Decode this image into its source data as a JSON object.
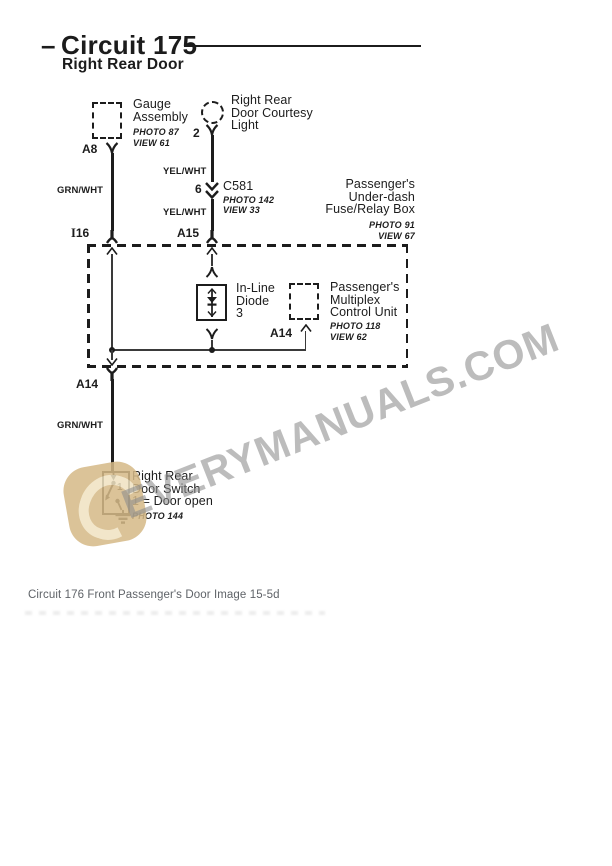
{
  "header": {
    "dash": "–",
    "title": "Circuit 175",
    "subtitle": "Right Rear Door"
  },
  "wire_labels": {
    "grn_wht_upper": "GRN/WHT",
    "yel_wht_upper": "YEL/WHT",
    "yel_wht_lower": "YEL/WHT",
    "grn_wht_lower": "GRN/WHT"
  },
  "pins": {
    "gauge": "A8",
    "light": "2",
    "c581": "6",
    "fusebox_left_prefix": "I",
    "fusebox_left": "16",
    "fusebox_mid": "A15",
    "multiplex": "A14",
    "fusebox_out": "A14",
    "switch_contact": "1"
  },
  "components": {
    "gauge_assembly": {
      "line1": "Gauge",
      "line2": "Assembly",
      "photo": "PHOTO 87",
      "view": "VIEW 61"
    },
    "courtesy_light": {
      "line1": "Right Rear",
      "line2": "Door Courtesy",
      "line3": "Light"
    },
    "connector_c581": {
      "name": "C581",
      "photo": "PHOTO 142",
      "view": "VIEW 33"
    },
    "fuse_relay_box": {
      "line1": "Passenger's",
      "line2": "Under-dash",
      "line3": "Fuse/Relay Box",
      "photo": "PHOTO 91",
      "view": "VIEW 67"
    },
    "inline_diode": {
      "line1": "In-Line",
      "line2": "Diode",
      "line3": "3"
    },
    "multiplex_unit": {
      "line1": "Passenger's",
      "line2": "Multiplex",
      "line3": "Control Unit",
      "photo": "PHOTO 118",
      "view": "VIEW 62"
    },
    "door_switch": {
      "line1": "Right Rear",
      "line2": "Door Switch",
      "line3": "1 = Door open",
      "photo": "PHOTO 144"
    }
  },
  "watermark": {
    "text": "EVERYMANUALS.COM"
  },
  "caption": "Circuit 176 Front Passenger's Door Image 15-5d",
  "colors": {
    "ink": "#1c1c1c",
    "watermark_gray": "#8d8d8d",
    "logo_tan": "#d6ba88",
    "logo_inner": "#f0e3c2",
    "caption_gray": "#5f6368"
  }
}
